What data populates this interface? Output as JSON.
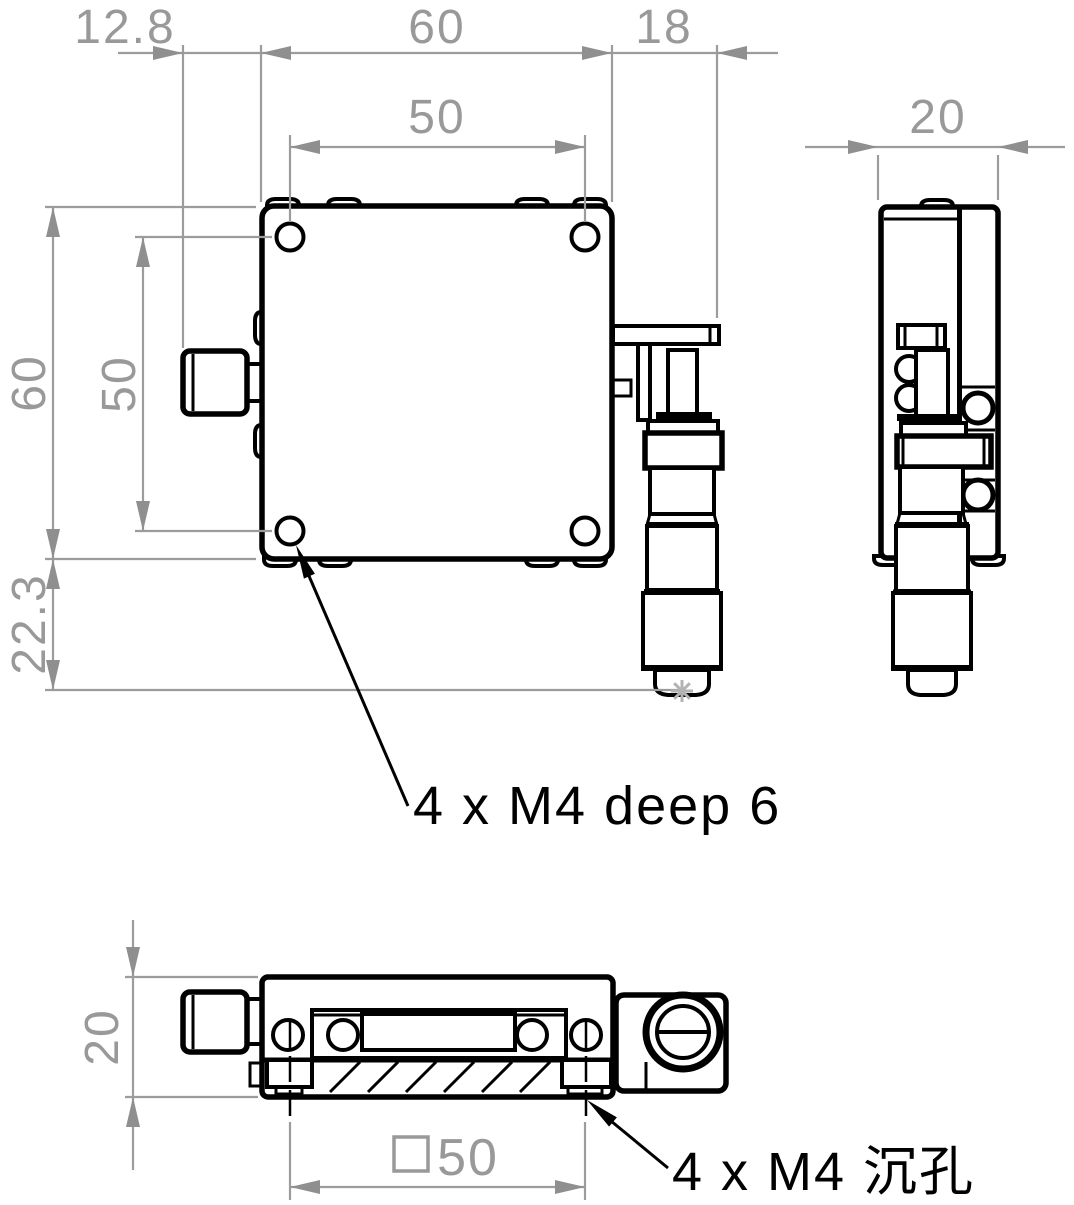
{
  "drawing": {
    "title": "XY translation stage dimension drawing",
    "dims": {
      "left_offset": "12.8",
      "body_width": "60",
      "bracket_extent": "18",
      "hole_spacing_h": "50",
      "body_height": "60",
      "hole_spacing_v": "50",
      "tip_offset": "22.3",
      "side_width": "20",
      "base_height": "20",
      "mount_spacing": "50",
      "mount_spacing_symbol": "□"
    },
    "annotations": {
      "tapped_holes": "4 x M4 deep 6",
      "counterbore_holes": "4 x M4 沉孔"
    },
    "colors": {
      "line": "#000000",
      "dimension": "#999999",
      "arrow_fill": "#8f8f8f",
      "star": "#b3b3b3"
    }
  }
}
